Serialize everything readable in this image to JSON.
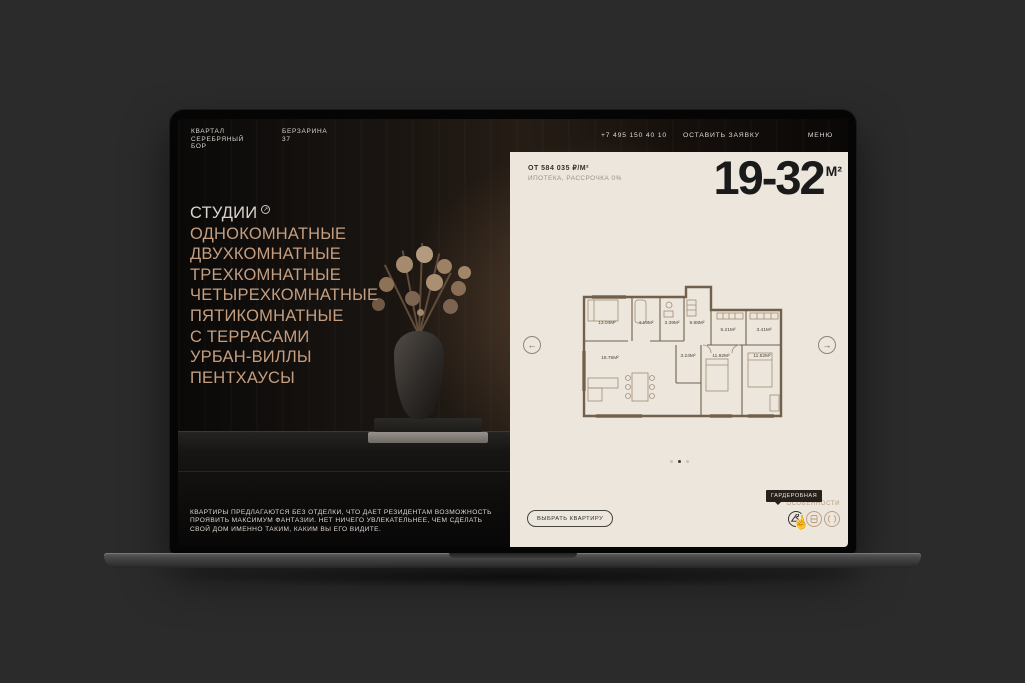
{
  "window": {
    "bg": "#2b2b2b"
  },
  "header": {
    "logo_lines": [
      "КВАРТАЛ",
      "СЕРЕБРЯНЫЙ",
      "БОР"
    ],
    "address_lines": [
      "БЕРЗАРИНА",
      "37"
    ],
    "phone": "+7 495 150 40 10",
    "request_label": "ОСТАВИТЬ ЗАЯВКУ",
    "menu_label": "МЕНЮ"
  },
  "nav": {
    "active_item": "СТУДИИ",
    "items": [
      "ОДНОКОМНАТНЫЕ",
      "ДВУХКОМНАТНЫЕ",
      "ТРЕХКОМНАТНЫЕ",
      "ЧЕТЫРЕХКОМНАТНЫЕ",
      "ПЯТИКОМНАТНЫЕ",
      "С ТЕРРАСАМИ",
      "УРБАН-ВИЛЛЫ",
      "ПЕНТХАУСЫ"
    ]
  },
  "intro": {
    "text": "КВАРТИРЫ ПРЕДЛАГАЮТСЯ БЕЗ ОТДЕЛКИ, ЧТО ДАЕТ РЕЗИДЕНТАМ ВОЗМОЖНОСТЬ ПРОЯВИТЬ МАКСИМУМ ФАНТАЗИИ. НЕТ НИЧЕГО УВЛЕКАТЕЛЬНЕЕ, ЧЕМ СДЕЛАТЬ СВОЙ ДОМ ИМЕННО ТАКИМ, КАКИМ ВЫ ЕГО ВИДИТЕ."
  },
  "offer": {
    "price_from": "ОТ 584 035 ₽/М²",
    "terms": "ИПОТЕКА, РАССРОЧКА 0%",
    "area_range": "19-32",
    "area_unit": "М²"
  },
  "plan": {
    "rooms": [
      "13.04М²",
      "4.19М²",
      "3.39М²",
      "9.88М²",
      "5.21М²",
      "3.41М²",
      "18.75М²",
      "3.24М²",
      "11.92М²",
      "11.52М²"
    ]
  },
  "carousel": {
    "dot_count": 3,
    "active_index": 1
  },
  "actions": {
    "select_label": "ВЫБРАТЬ КВАРТИРУ",
    "features_label": "ОСОБЕННОСТИ",
    "tooltip_label": "ГАРДЕРОБНАЯ",
    "feature_icons": [
      "hanger-icon",
      "window-icon",
      "arch-window-icon"
    ]
  },
  "colors": {
    "panel_bg": "#ece6dc",
    "accent_tan": "#c59e80",
    "text_dark": "#1a1a1a",
    "plan_line": "#71604b",
    "tooltip_bg": "#27211b"
  }
}
